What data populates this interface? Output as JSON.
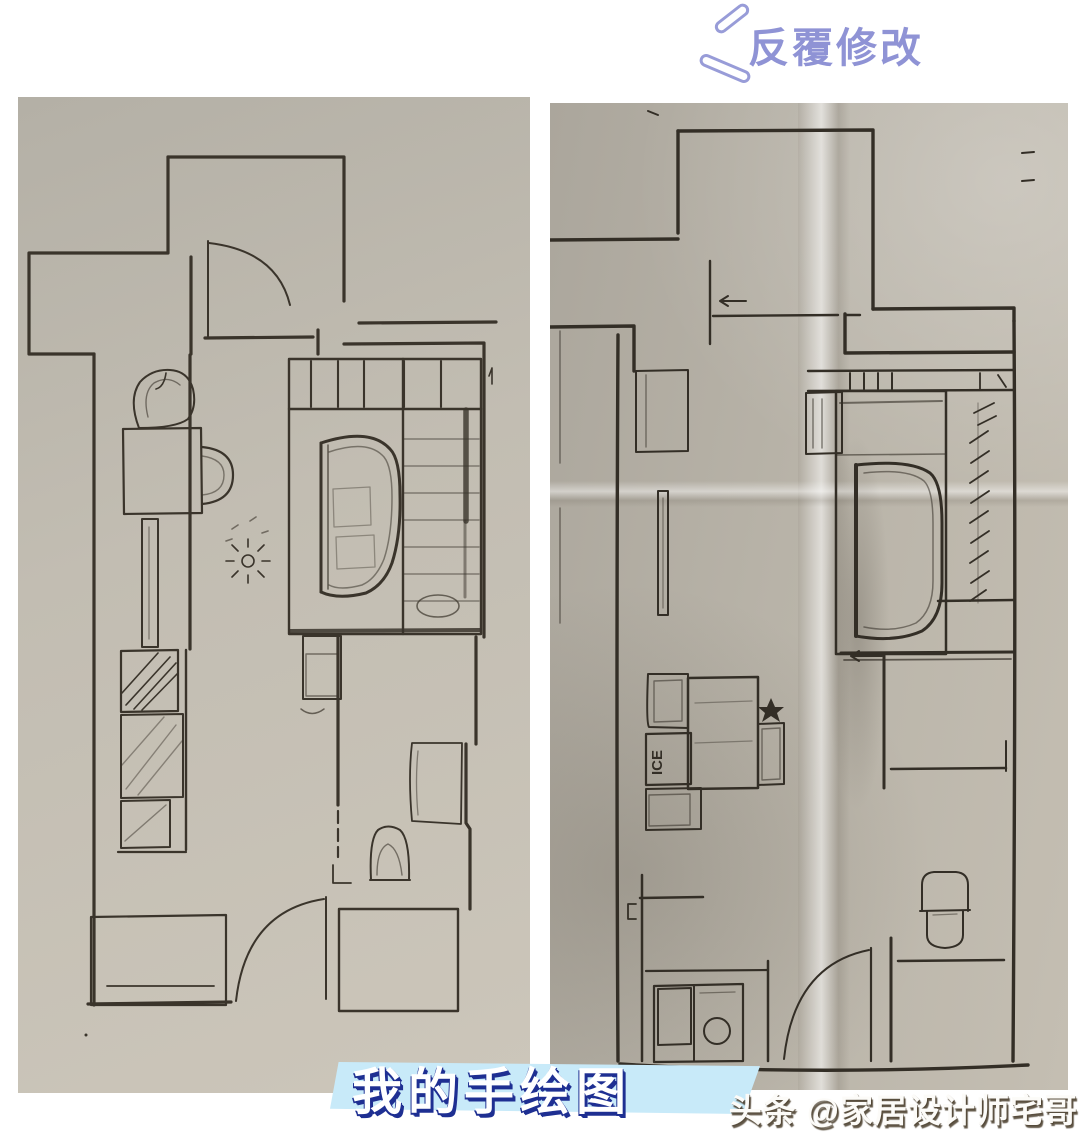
{
  "stamp": {
    "text": "反覆修改",
    "color": "#8f93d5"
  },
  "caption": {
    "text": "我的手绘图",
    "text_color": "#ffffff",
    "shadow_color": "#1e2f92",
    "band_color": "#c8eaf9"
  },
  "watermark": {
    "text": "头条 @家居设计师宅哥",
    "color": "#fcfbf8"
  },
  "left_photo": {
    "paper_color": "#c1bcb1",
    "ink_color": "#3a342b"
  },
  "right_photo": {
    "paper_color": "#b9b4aa",
    "ink_color": "#332e26",
    "fridge_label": "ICE"
  }
}
